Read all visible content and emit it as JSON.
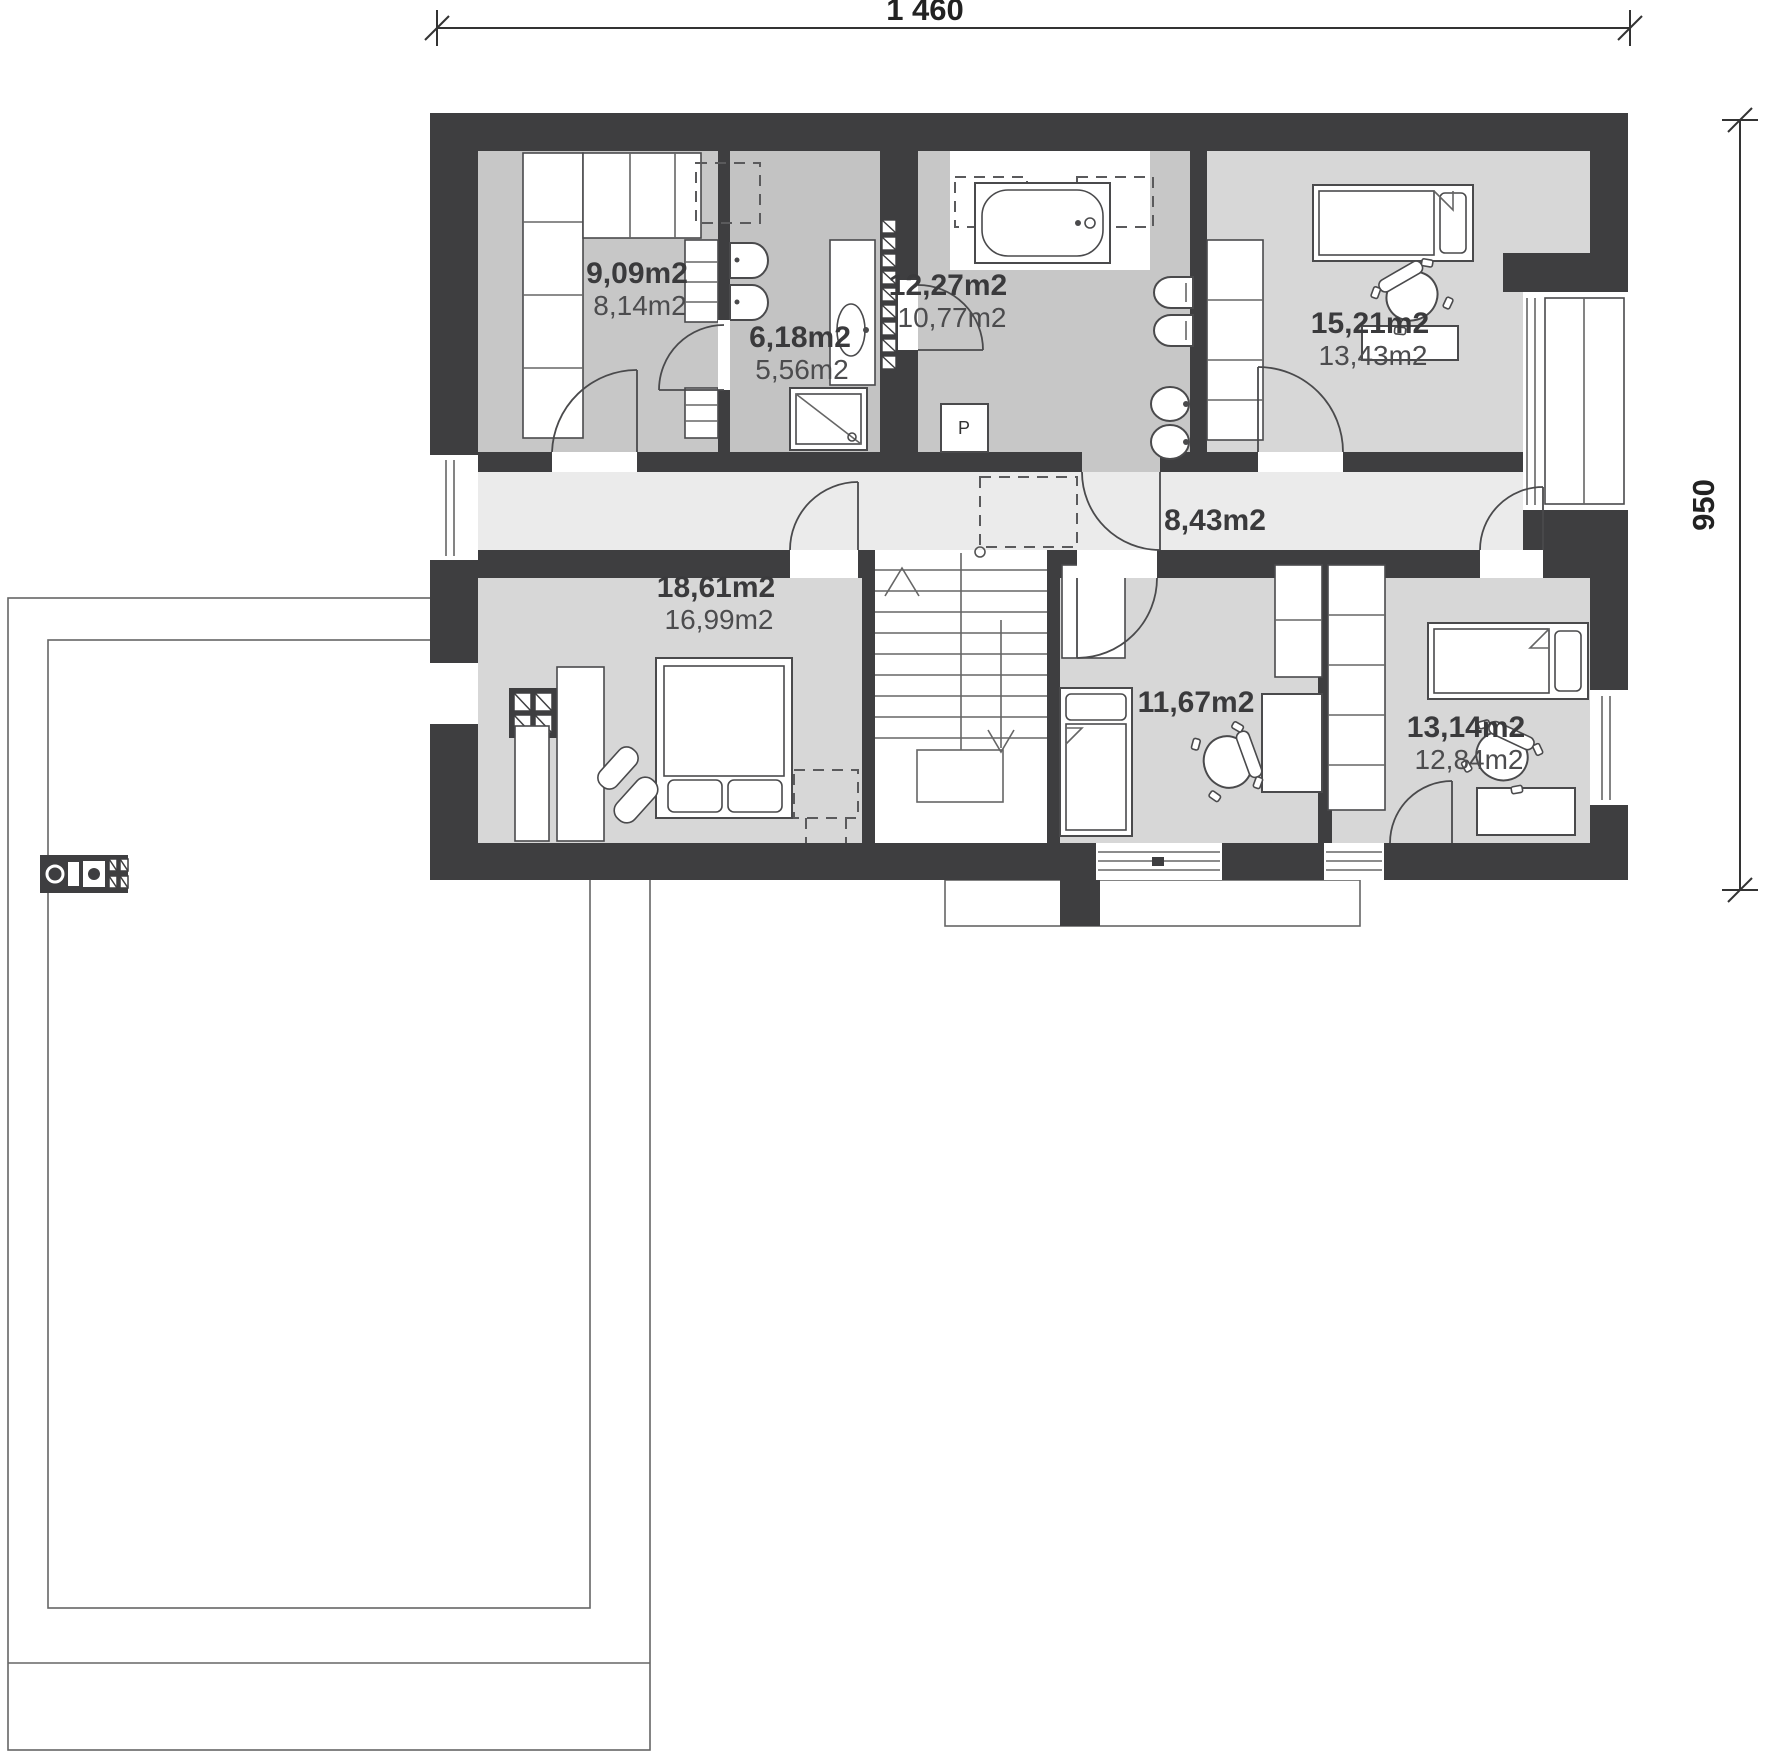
{
  "dimensions": {
    "top": "1 460",
    "right": "950"
  },
  "rooms": [
    {
      "key": "wardrobe-room",
      "area": "9,09m2",
      "floor_area": "8,14m2"
    },
    {
      "key": "washroom",
      "area": "6,18m2",
      "floor_area": "5,56m2"
    },
    {
      "key": "bathroom",
      "area": "12,27m2",
      "floor_area": "10,77m2"
    },
    {
      "key": "bedroom-top-right",
      "area": "15,21m2",
      "floor_area": "13,43m2"
    },
    {
      "key": "hallway",
      "area": "8,43m2"
    },
    {
      "key": "bedroom-left",
      "area": "18,61m2",
      "floor_area": "16,99m2"
    },
    {
      "key": "bedroom-middle",
      "area": "11,67m2"
    },
    {
      "key": "bedroom-bottom-right",
      "area": "13,14m2",
      "floor_area": "12,84m2"
    }
  ],
  "appliances": {
    "washer_label": "P"
  },
  "colors": {
    "walls": "#3e3e40",
    "bedroom_floor": "#d7d7d7",
    "bath_floor": "#c7c7c7",
    "hall_floor": "#ebebeb",
    "line": "#4a4a4c"
  }
}
